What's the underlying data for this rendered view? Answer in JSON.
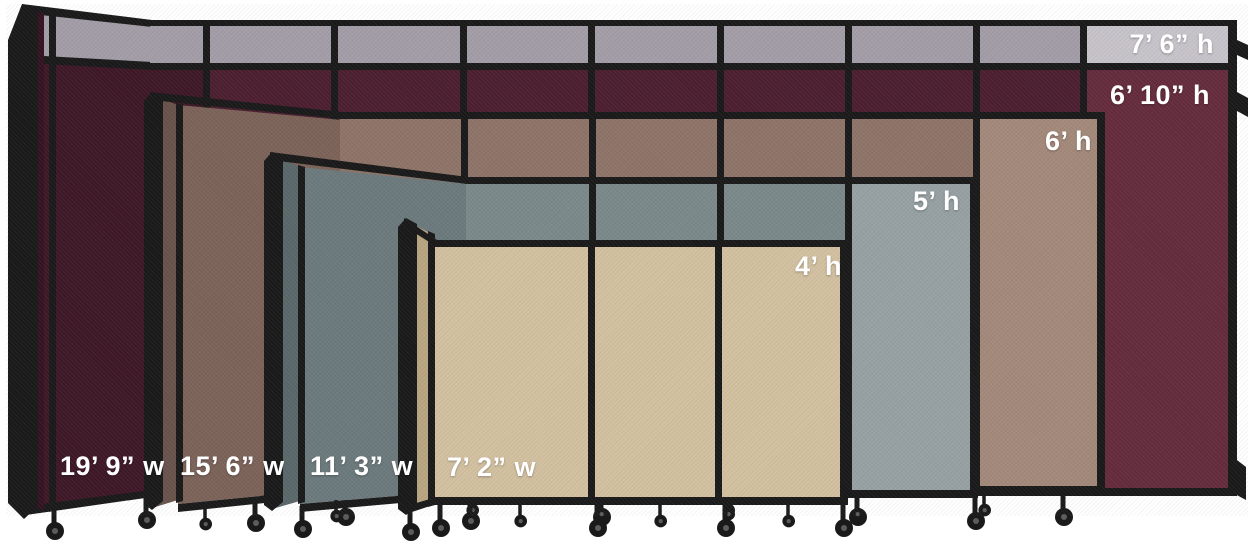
{
  "page": {
    "background_color": "#ffffff",
    "frame_color": "#1a1a1a",
    "label_color": "#ffffff"
  },
  "dividers": [
    {
      "name": "divider-19ft9",
      "width_label": "19’ 9” w",
      "height_label": "6’ 10” h",
      "extended_height_label": "7’ 6” h",
      "fabric_color": "#4c1f30",
      "fabric_highlight_color": "#652c3e",
      "angled_color": "#3f1827",
      "return_color": "#341322",
      "topper_color": "#a39da7",
      "topper_highlight_color": "#c7c3ca"
    },
    {
      "name": "divider-15ft6",
      "width_label": "15’ 6” w",
      "height_label": "6’ h",
      "fabric_color": "#8e7468",
      "fabric_highlight_color": "#a3897a",
      "angled_color": "#7c635a",
      "return_color": "#68544c"
    },
    {
      "name": "divider-11ft3",
      "width_label": "11’ 3” w",
      "height_label": "5’ h",
      "fabric_color": "#7b898b",
      "fabric_highlight_color": "#97a1a3",
      "angled_color": "#6c7a7d",
      "return_color": "#5a686b"
    },
    {
      "name": "divider-7ft2",
      "width_label": "7’ 2” w",
      "height_label": "4’ h",
      "fabric_color": "#d2c0a0",
      "fabric_highlight_color": "#d8c7a8",
      "angled_color": "#c7b38f",
      "return_color": "#b9a582"
    }
  ]
}
